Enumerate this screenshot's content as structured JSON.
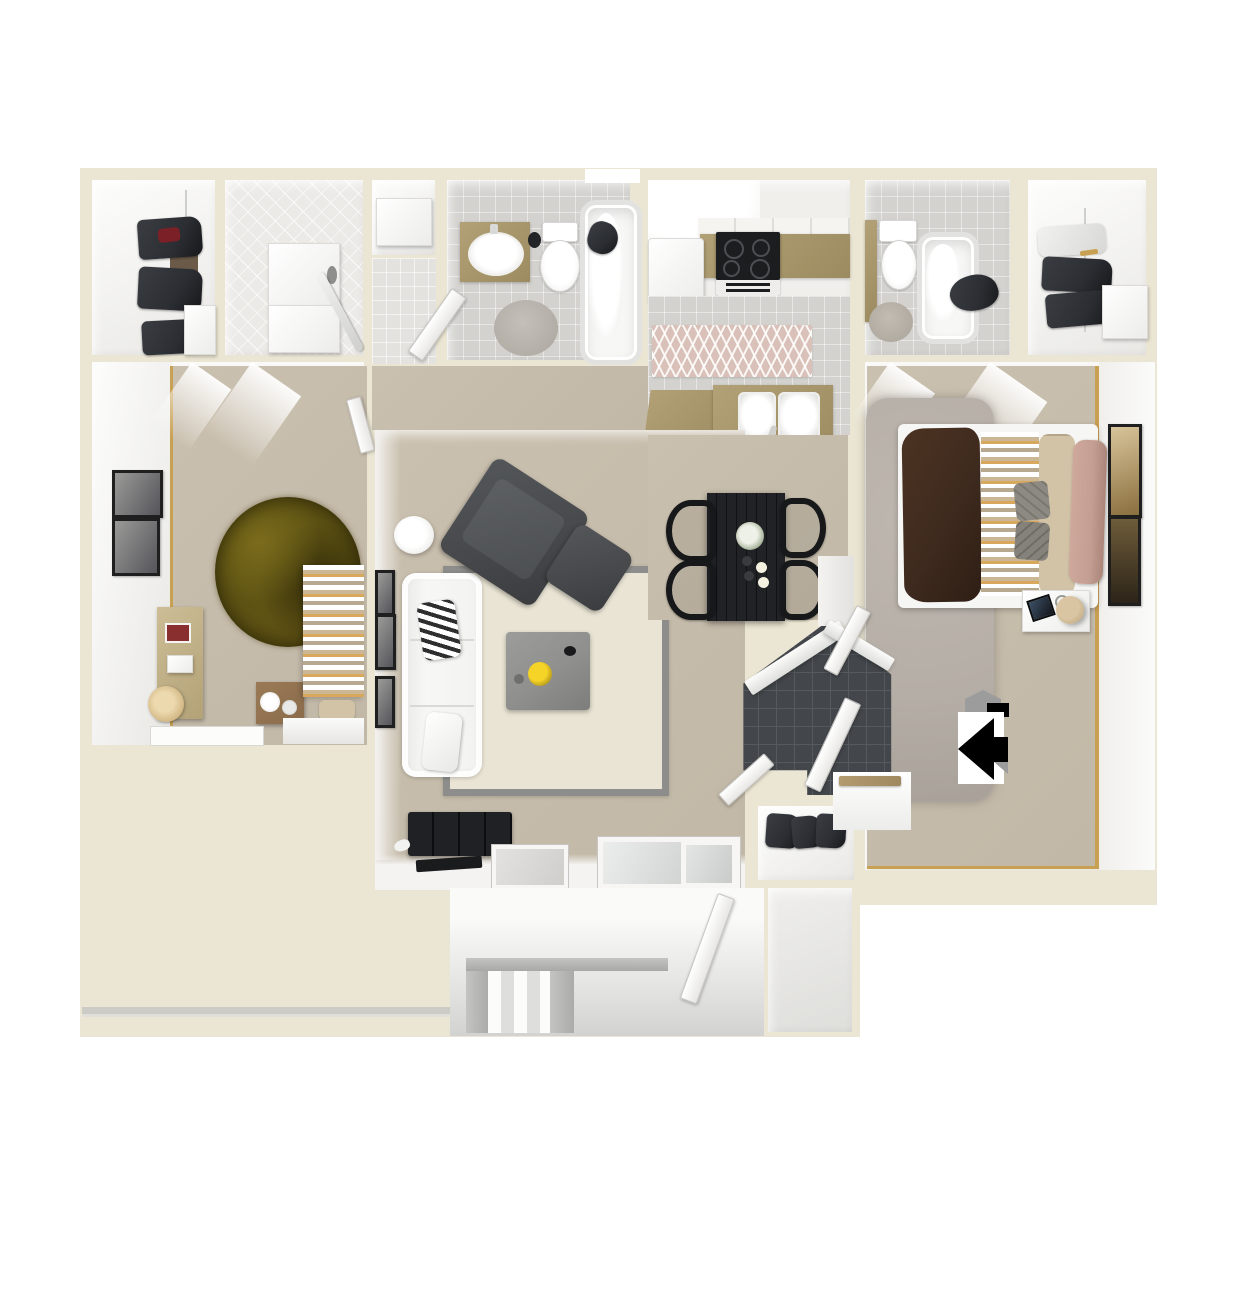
{
  "title": "3D apartment floor plan, top-down view",
  "legend": {
    "entry_marker": "entry-arrow"
  },
  "rooms": [
    {
      "id": "walk-in-closet-left",
      "name": "Walk-in Closet",
      "furniture": [
        "clothes rod",
        "hanging clothes",
        "dresser",
        "shelf bench"
      ]
    },
    {
      "id": "laundry-room",
      "name": "Laundry Room",
      "furniture": [
        "washer",
        "dryer",
        "ironing board"
      ]
    },
    {
      "id": "linen-closet",
      "name": "Linen Closet",
      "furniture": [
        "storage box"
      ]
    },
    {
      "id": "bathroom-top",
      "name": "Bathroom",
      "furniture": [
        "vanity sink",
        "toilet",
        "bathtub",
        "round bath rug",
        "towel",
        "waste bin",
        "door"
      ]
    },
    {
      "id": "kitchen",
      "name": "Kitchen",
      "furniture": [
        "refrigerator",
        "range stove",
        "upper cabinets",
        "tan countertop",
        "chevron runner rug",
        "double sink",
        "breakfast bar"
      ]
    },
    {
      "id": "bathroom-right",
      "name": "Bathroom",
      "furniture": [
        "toilet",
        "bathtub",
        "bath rug",
        "towel"
      ]
    },
    {
      "id": "walk-in-closet-right",
      "name": "Walk-in Closet",
      "furniture": [
        "clothes rod",
        "hanging clothes",
        "dresser"
      ]
    },
    {
      "id": "bedroom-left",
      "name": "Bedroom",
      "furniture": [
        "bed with striped linens",
        "round olive shag rug",
        "bookshelf",
        "crate nightstand",
        "two wall art frames",
        "window sill"
      ]
    },
    {
      "id": "living-room",
      "name": "Living Room",
      "furniture": [
        "white sofa",
        "striped pillow",
        "area rug",
        "gray coffee table",
        "yellow flowers",
        "dark accent chair",
        "ottoman",
        "media console",
        "side table lamp",
        "wall art frames",
        "sliding glass door",
        "window"
      ]
    },
    {
      "id": "dining-area",
      "name": "Dining Area",
      "furniture": [
        "black dining table",
        "four black chairs",
        "flower centerpiece",
        "place settings"
      ]
    },
    {
      "id": "bedroom-right",
      "name": "Bedroom",
      "furniture": [
        "bed with brown blanket",
        "striped runner",
        "tan cushions",
        "mauve pillow",
        "gray shag rug",
        "nightstand",
        "table lamp",
        "two wall art frames"
      ]
    },
    {
      "id": "entry-foyer",
      "name": "Entry Foyer",
      "furniture": [
        "dark tile floor",
        "entry door",
        "interior doors"
      ]
    },
    {
      "id": "coat-closet",
      "name": "Coat Closet",
      "furniture": [
        "clothes rod",
        "hanging clothes"
      ]
    },
    {
      "id": "patio",
      "name": "Patio",
      "furniture": [
        "steps",
        "railing",
        "patio door"
      ]
    },
    {
      "id": "patio-storage",
      "name": "Storage Closet",
      "furniture": []
    },
    {
      "id": "entry-landing",
      "name": "Entry Landing",
      "furniture": [
        "bench"
      ]
    }
  ],
  "colors": {
    "page_bg": "#ffffff",
    "wall": "#ebe6d3",
    "tile_gray": "#d3d2cf",
    "carpet_beige": "#cac0af",
    "area_rug_cream": "#e9e4d4",
    "area_rug_border": "#8d8d8b",
    "rug_olive": "#5f5414",
    "shag_gray": "#b5aea6",
    "counter_tan": "#b2a176",
    "counter_tan_dark": "#9c8b60",
    "appliance_black": "#1c1d1f",
    "chair_dark": "#47494c",
    "table_gray": "#8f8f8d",
    "dining_black": "#212225",
    "foyer_tile": "#43474b",
    "foyer_tile_line": "#555a5e",
    "bed_brown": "#3e2a1e",
    "pillow_tan": "#d2c3a7",
    "pillow_mauve": "#c39e92",
    "stripe_gold": "#d8a85c",
    "runner_pink": "#d9c0b8",
    "wood_brown": "#8a6b4a",
    "clothes_dark": "#2b2e33",
    "patio_gray": "#d9d9d8",
    "railing_gray": "#a8a8a6",
    "arrow_black": "#000000",
    "arrow_gray": "#9c9c9c",
    "gold_threshold": "#c8a052",
    "frame_black": "#1f1f1f",
    "flower_yellow": "#f5d327"
  }
}
